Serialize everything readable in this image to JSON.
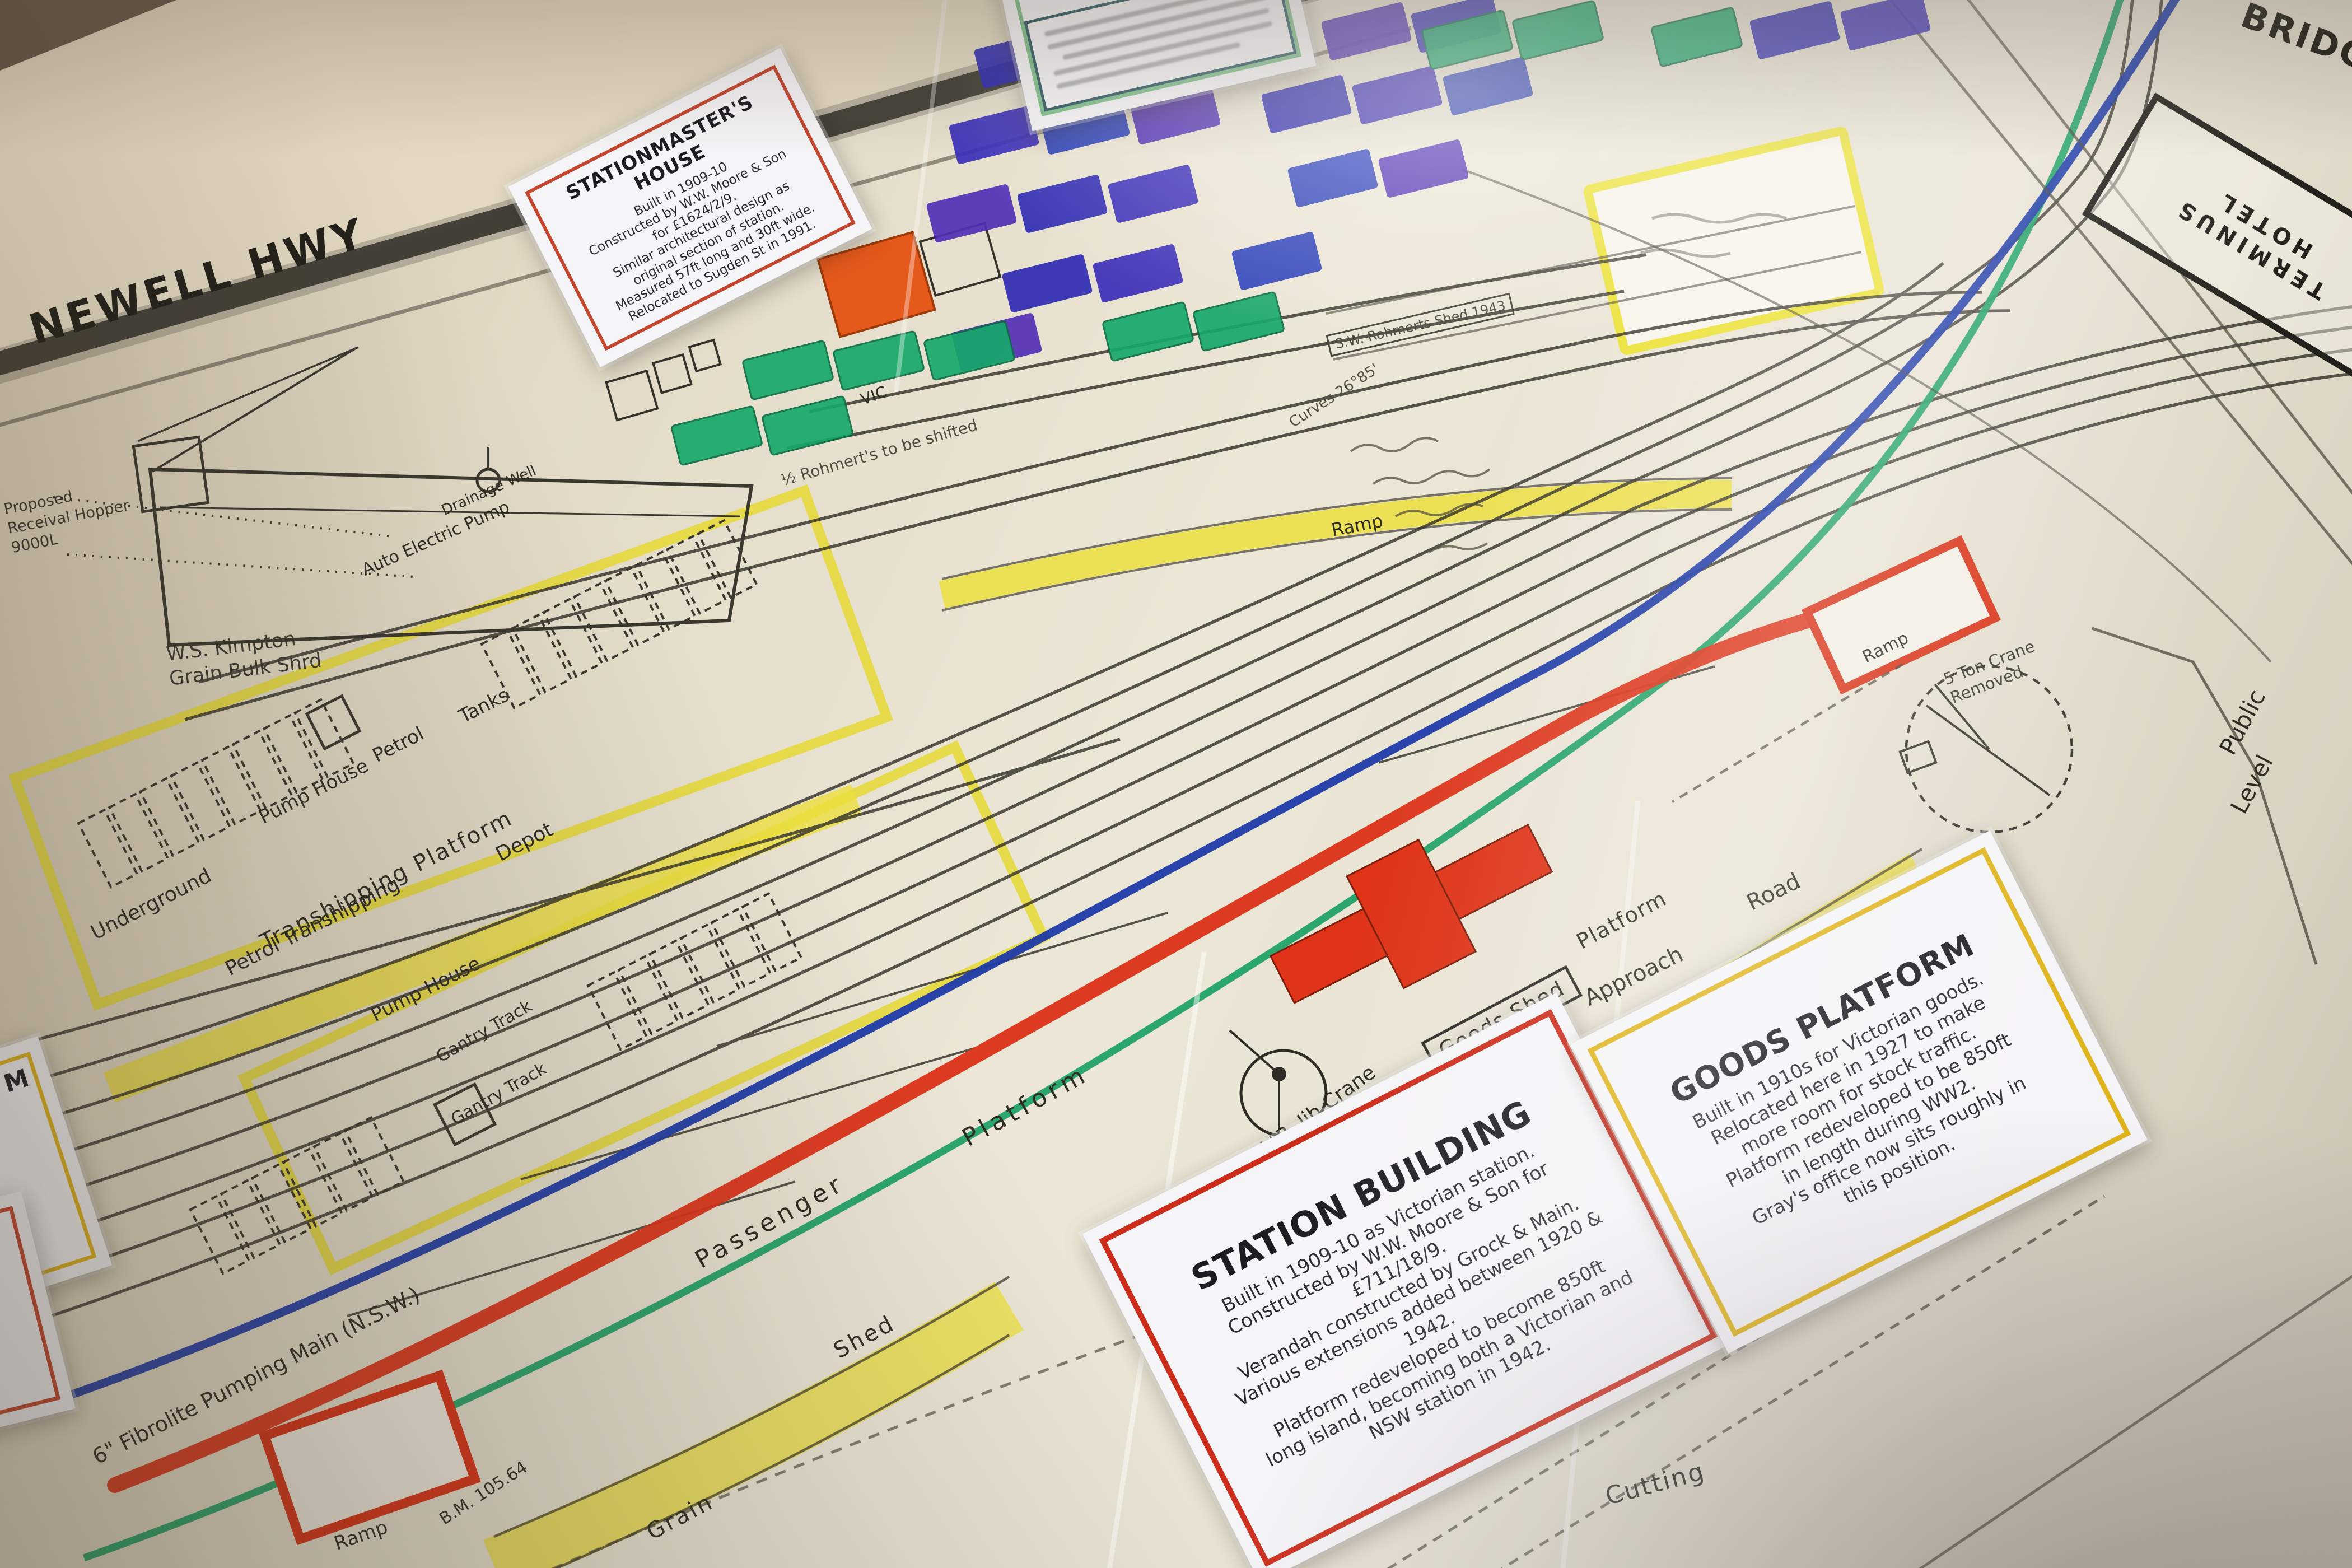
{
  "cards": {
    "stationmasters_house": {
      "title": "STATIONMASTER'S HOUSE",
      "lines": [
        "Built in 1909-10",
        "Constructed by W.W. Moore & Son",
        "for £1624/2/9.",
        "Similar architectural design as",
        "original section of station.",
        "Measured 57ft long and 30ft wide.",
        "Relocated to Sugden St in 1991."
      ]
    },
    "station_building": {
      "title": "STATION BUILDING",
      "lines": [
        "Built in 1909-10 as Victorian station.",
        "Constructed by W.W. Moore & Son for",
        "£711/18/9.",
        "Verandah constructed by Grock & Main.",
        "Various extensions added between 1920 &",
        "1942.",
        "Platform redeveloped to become 850ft",
        "long island, becoming both a Victorian and",
        "NSW station in 1942."
      ]
    },
    "goods_platform": {
      "title": "GOODS PLATFORM",
      "lines": [
        "Built in 1910s for Victorian goods.",
        "Relocated here in 1927 to make",
        "more room for stock traffic.",
        "Platform redeveloped to be 850ft",
        "in length during WW2.",
        "Gray's office now sits roughly in",
        "this position."
      ]
    }
  },
  "labels": {
    "newell_hwy": "NEWELL HWY",
    "bridge": "BRIDGE",
    "proposed_1": "Proposed",
    "proposed_2": "Receival Hopper",
    "proposed_3": "9000L",
    "kimpton_1": "W.S. Kimpton",
    "kimpton_2": "Grain Bulk Shrd",
    "drainage_well": "Drainage Well",
    "auto_pump": "Auto Electric Pump",
    "underground": "Underground",
    "pump_house_1": "Pump House",
    "petrol": "Petrol",
    "tanks": "Tanks",
    "transhipping_platform": "Transhipping Platform",
    "petrol_transhipping": "Petrol Transhipping",
    "depot": "Depot",
    "pump_house_2": "Pump House",
    "gantry_track_1": "Gantry Track",
    "gantry_track_2": "Gantry Track",
    "passenger": "Passenger",
    "platform_1": "Platform",
    "goods": "Goods",
    "goods_shed": "Goods Shed",
    "platform_2": "Platform",
    "approach": "Approach",
    "road": "Road",
    "metalled": "Metalled",
    "jib_crane": "2½ T V.R. Jib Crane",
    "cutting": "Cutting",
    "grain": "Grain",
    "shed": "Shed",
    "ramp_yellow": "Ramp",
    "ramp_ne": "Ramp",
    "ramp_sw": "Ramp",
    "bench_mark": "B.M. 105.64",
    "fibrolite": "6\" Fibrolite Pumping Main (N.S.W.)",
    "crane_removed_1": "5 Ton Crane",
    "crane_removed_2": "Removed",
    "public": "Public",
    "level": "Level",
    "vic": "VIC",
    "rohmerts_note": "½ Rohmert's to be shifted",
    "rohmerts_shed": "S.W. Rohmerts Shed 1943",
    "curves_note": "Curves 26°85'",
    "terminus_1": "TERMINUS",
    "terminus_2": "HOTEL",
    "cut_card_m": "M"
  },
  "colors": {
    "highlight_yellow": "#ecdf3e",
    "platform_red": "#dc3217",
    "line_blue": "#1e3aa8",
    "line_green": "#21a266",
    "building_indigo": "#2f2bb3",
    "building_green": "#17a86b",
    "building_orange": "#e5591b",
    "card_red_frame": "#cc2c1a",
    "card_yellow_frame": "#e0b41c"
  }
}
